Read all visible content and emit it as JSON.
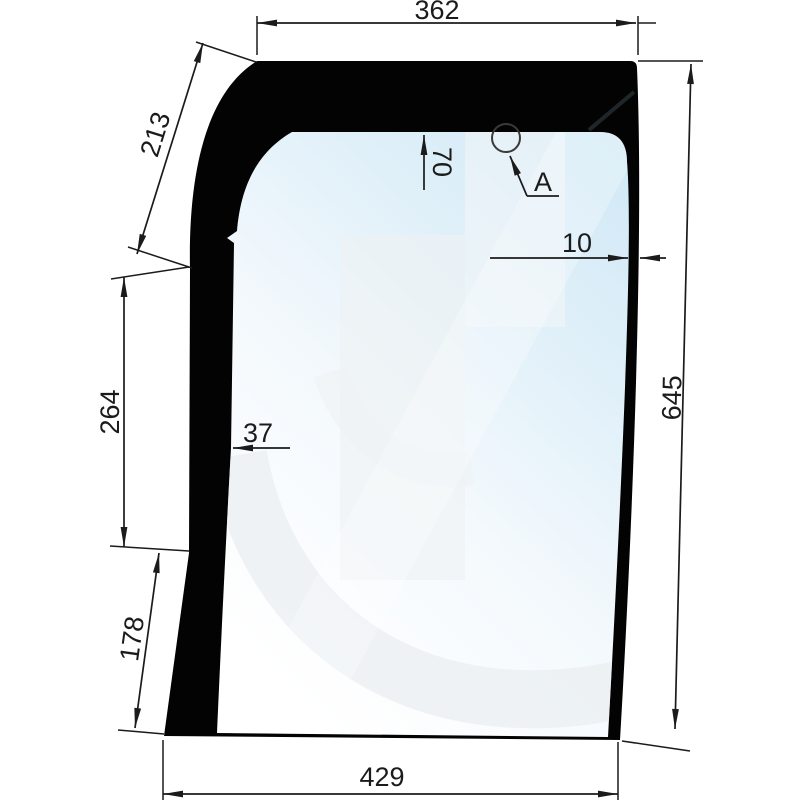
{
  "drawing": {
    "title": "cab-glass-panel-technical-drawing",
    "dimensions": {
      "top_width": "362",
      "upper_left_curve": "213",
      "left_upper_segment": "264",
      "left_lower_segment": "178",
      "bottom_width": "429",
      "right_height": "645",
      "hole_vertical_offset": "70",
      "right_border_thickness": "10",
      "left_border_thickness": "37"
    },
    "labels": {
      "hole": "A"
    },
    "colors": {
      "frame": "#030303",
      "glass_white": "#ffffff",
      "glass_blue": "#cfe8f6",
      "dimension_line": "#1b1b1b"
    }
  }
}
